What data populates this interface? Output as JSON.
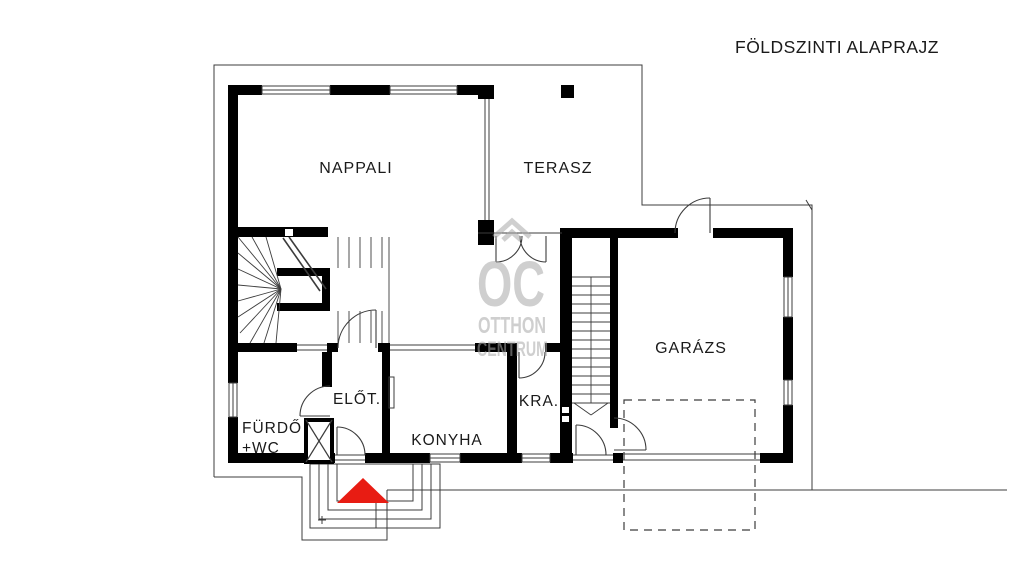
{
  "title": "FÖLDSZINTI ALAPRAJZ",
  "rooms": {
    "living": "NAPPALI",
    "terrace": "TERASZ",
    "garage": "GARÁZS",
    "hall": "ELŐT.",
    "kitchen": "KONYHA",
    "pantry": "KRA.",
    "bathroom_line1": "FÜRDŐ",
    "bathroom_line2": "+WC"
  },
  "watermark": {
    "initials": "OC",
    "name_line1": "OTTHON",
    "name_line2": "CENTRUM"
  },
  "colors": {
    "wall": "#000000",
    "thin_line": "#3c3c3c",
    "watermark": "#a8a8a8",
    "entrance_marker": "#e81c13",
    "background": "#ffffff"
  }
}
